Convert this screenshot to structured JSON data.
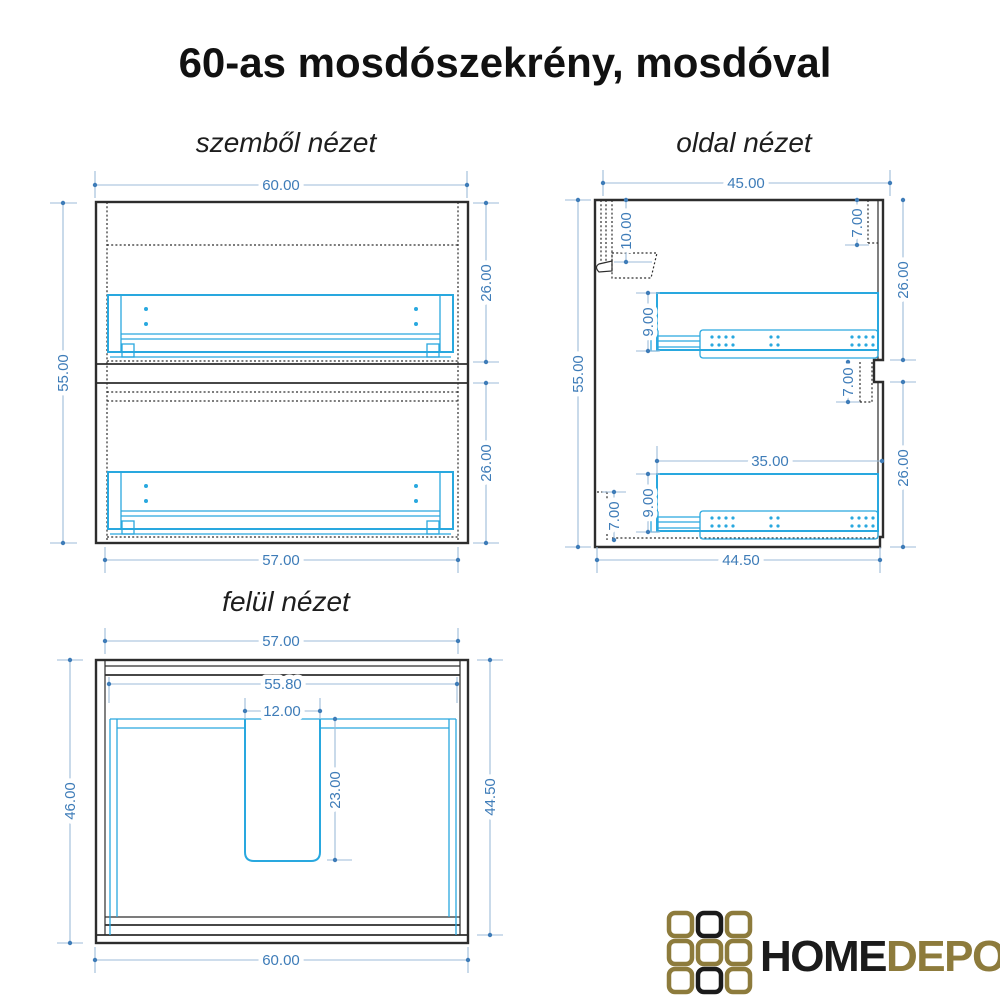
{
  "page": {
    "title": "60-as mosdószekrény, mosdóval"
  },
  "views": {
    "front": {
      "label": "szemből nézet",
      "dims": {
        "width_top": "60.00",
        "height": "55.00",
        "upper_drawer": "26.00",
        "lower_drawer": "26.00",
        "width_bottom": "57.00"
      }
    },
    "side": {
      "label": "oldal nézet",
      "dims": {
        "depth_top": "45.00",
        "height": "55.00",
        "back_offset": "10.00",
        "front_top": "7.00",
        "upper_section": "26.00",
        "upper_rail": "9.00",
        "front_mid": "7.00",
        "rail_length": "35.00",
        "lower_rail": "9.00",
        "plinth": "7.00",
        "lower_section": "26.00",
        "depth_bottom": "44.50"
      }
    },
    "top": {
      "label": "felül nézet",
      "dims": {
        "width_top": "57.00",
        "inner_width": "55.80",
        "cutout_width": "12.00",
        "cutout_depth": "23.00",
        "depth_left": "46.00",
        "depth_right": "44.50",
        "width_bottom": "60.00"
      }
    }
  },
  "logo": {
    "primary": "HOME",
    "secondary": "DEPO"
  },
  "colors": {
    "dimension_blue": "#3e7cb8",
    "dimension_line": "#9dbbd8",
    "drawing_cyan": "#29a8df",
    "outline_black": "#2d2d2d",
    "logo_gold": "#8d7b3c",
    "logo_black": "#1b1b1b"
  }
}
